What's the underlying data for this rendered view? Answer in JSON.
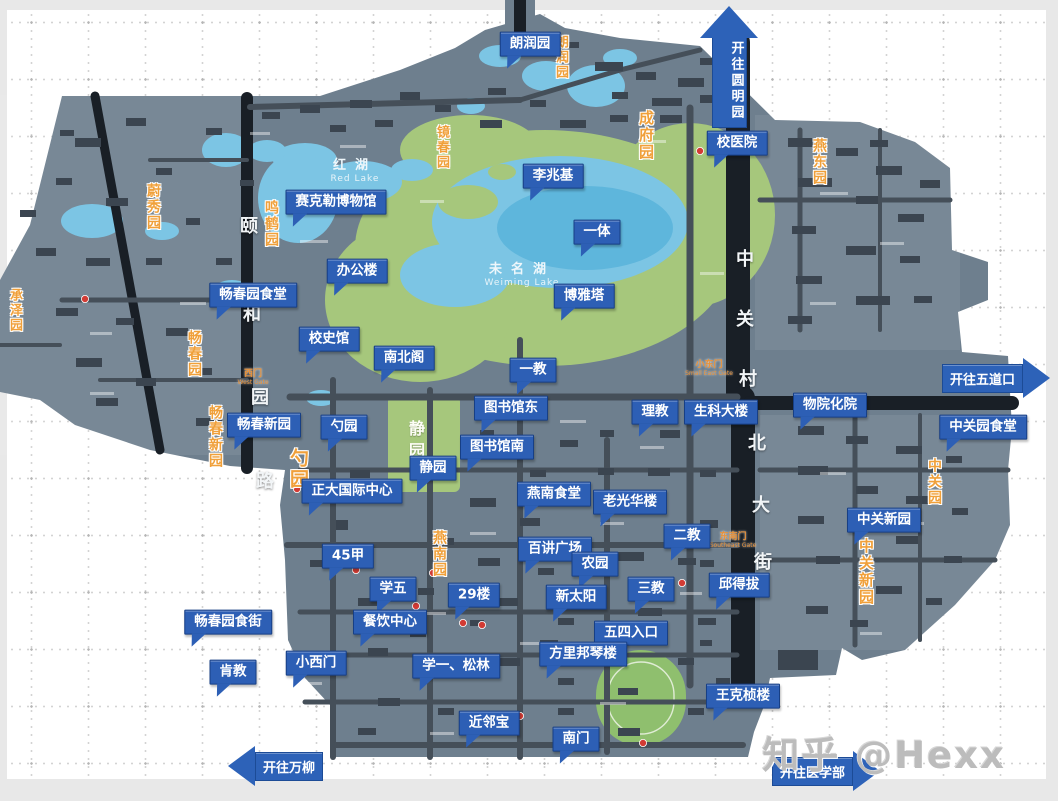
{
  "watermark": {
    "text": "知乎 @Hexx"
  },
  "colors": {
    "callout_fill": "#2d5fb5",
    "callout_border": "#173f85",
    "land": "#6e7f8e",
    "building": "#3b4550",
    "road_dark": "#191f26",
    "road_mid": "#454f59",
    "water": "#7cc5e4",
    "water_deep": "#54b0da",
    "green": "#a6c77c",
    "field_green": "#8fbf6e",
    "orange_label": "#f0a03a",
    "marker_red": "#d23b34"
  },
  "callouts": [
    {
      "label": "朗润园",
      "x": 530,
      "y": 44
    },
    {
      "label": "校医院",
      "x": 737,
      "y": 143
    },
    {
      "label": "李兆基",
      "x": 553,
      "y": 176
    },
    {
      "label": "赛克勒博物馆",
      "x": 336,
      "y": 202
    },
    {
      "label": "一体",
      "x": 597,
      "y": 232
    },
    {
      "label": "办公楼",
      "x": 357,
      "y": 271
    },
    {
      "label": "畅春园食堂",
      "x": 253,
      "y": 295
    },
    {
      "label": "博雅塔",
      "x": 584,
      "y": 296
    },
    {
      "label": "校史馆",
      "x": 329,
      "y": 339
    },
    {
      "label": "南北阁",
      "x": 404,
      "y": 358
    },
    {
      "label": "一教",
      "x": 533,
      "y": 370
    },
    {
      "label": "图书馆东",
      "x": 511,
      "y": 408
    },
    {
      "label": "理教",
      "x": 655,
      "y": 412
    },
    {
      "label": "生科大楼",
      "x": 721,
      "y": 412
    },
    {
      "label": "物院化院",
      "x": 830,
      "y": 405
    },
    {
      "label": "中关园食堂",
      "x": 983,
      "y": 427
    },
    {
      "label": "畅春新园",
      "x": 264,
      "y": 425
    },
    {
      "label": "勺园",
      "x": 344,
      "y": 427
    },
    {
      "label": "图书馆南",
      "x": 497,
      "y": 447
    },
    {
      "label": "静园",
      "x": 433,
      "y": 468
    },
    {
      "label": "正大国际中心",
      "x": 352,
      "y": 491
    },
    {
      "label": "燕南食堂",
      "x": 554,
      "y": 494
    },
    {
      "label": "老光华楼",
      "x": 630,
      "y": 502
    },
    {
      "label": "中关新园",
      "x": 884,
      "y": 520
    },
    {
      "label": "二教",
      "x": 687,
      "y": 536
    },
    {
      "label": "45甲",
      "x": 348,
      "y": 556
    },
    {
      "label": "百讲广场",
      "x": 555,
      "y": 549
    },
    {
      "label": "农园",
      "x": 595,
      "y": 564
    },
    {
      "label": "学五",
      "x": 393,
      "y": 589
    },
    {
      "label": "三教",
      "x": 651,
      "y": 589
    },
    {
      "label": "邱得拔",
      "x": 739,
      "y": 585
    },
    {
      "label": "新太阳",
      "x": 576,
      "y": 597
    },
    {
      "label": "29楼",
      "x": 474,
      "y": 595
    },
    {
      "label": "餐饮中心",
      "x": 390,
      "y": 622
    },
    {
      "label": "畅春园食街",
      "x": 228,
      "y": 622
    },
    {
      "label": "五四入口",
      "x": 631,
      "y": 633
    },
    {
      "label": "方里邦琴楼",
      "x": 583,
      "y": 654
    },
    {
      "label": "小西门",
      "x": 316,
      "y": 663
    },
    {
      "label": "学一、松林",
      "x": 456,
      "y": 666
    },
    {
      "label": "肯教",
      "x": 233,
      "y": 672
    },
    {
      "label": "王克桢楼",
      "x": 743,
      "y": 696
    },
    {
      "label": "近邻宝",
      "x": 489,
      "y": 723
    },
    {
      "label": "南门",
      "x": 576,
      "y": 739
    }
  ],
  "direction_arrows": [
    {
      "label": "开往圆明园",
      "direction": "up",
      "x": 699,
      "y": 6
    },
    {
      "label": "开往五道口",
      "direction": "right",
      "x": 942,
      "y": 358
    },
    {
      "label": "开往万柳",
      "direction": "left",
      "x": 228,
      "y": 746
    },
    {
      "label": "开往医学部",
      "direction": "right",
      "x": 772,
      "y": 751
    }
  ],
  "garden_labels": [
    {
      "text": "朗润园",
      "x": 554,
      "y": 35,
      "size": 13
    },
    {
      "text": "成府园",
      "x": 638,
      "y": 110,
      "size": 15
    },
    {
      "text": "燕东园",
      "x": 812,
      "y": 138,
      "size": 14
    },
    {
      "text": "镜春园",
      "x": 435,
      "y": 125,
      "size": 13
    },
    {
      "text": "蔚秀园",
      "x": 146,
      "y": 183,
      "size": 14
    },
    {
      "text": "鸣鹤园",
      "x": 264,
      "y": 200,
      "size": 14
    },
    {
      "text": "承泽园",
      "x": 8,
      "y": 288,
      "size": 13
    },
    {
      "text": "畅春园",
      "x": 187,
      "y": 330,
      "size": 14
    },
    {
      "text": "畅春新园",
      "x": 208,
      "y": 405,
      "size": 14
    },
    {
      "text": "勺园",
      "x": 288,
      "y": 448,
      "size": 19
    },
    {
      "text": "燕南园",
      "x": 432,
      "y": 530,
      "size": 14
    },
    {
      "text": "中关园",
      "x": 927,
      "y": 458,
      "size": 14
    },
    {
      "text": "中关新园",
      "x": 858,
      "y": 538,
      "size": 15
    }
  ],
  "gate_labels": [
    {
      "text": "西门",
      "en": "West Gate",
      "x": 253,
      "y": 370
    },
    {
      "text": "小东门",
      "en": "Small East Gate",
      "x": 709,
      "y": 361
    },
    {
      "text": "东南门",
      "en": "Southeast Gate",
      "x": 733,
      "y": 533
    }
  ],
  "road_name_chars": [
    {
      "ch": "颐",
      "x": 240,
      "y": 218
    },
    {
      "ch": "和",
      "x": 243,
      "y": 306
    },
    {
      "ch": "园",
      "x": 251,
      "y": 389
    },
    {
      "ch": "路",
      "x": 256,
      "y": 473
    },
    {
      "ch": "中",
      "x": 736,
      "y": 251
    },
    {
      "ch": "关",
      "x": 736,
      "y": 311
    },
    {
      "ch": "村",
      "x": 739,
      "y": 371
    },
    {
      "ch": "北",
      "x": 748,
      "y": 435
    },
    {
      "ch": "大",
      "x": 752,
      "y": 497
    },
    {
      "ch": "街",
      "x": 754,
      "y": 554
    }
  ],
  "water_labels": [
    {
      "zh": "红湖",
      "en": "Red Lake",
      "x": 355,
      "y": 158
    },
    {
      "zh": "未名湖",
      "en": "Weiming Lake",
      "x": 522,
      "y": 262
    }
  ],
  "lawn_labels": [
    {
      "text": "静园",
      "x": 407,
      "y": 420
    }
  ]
}
